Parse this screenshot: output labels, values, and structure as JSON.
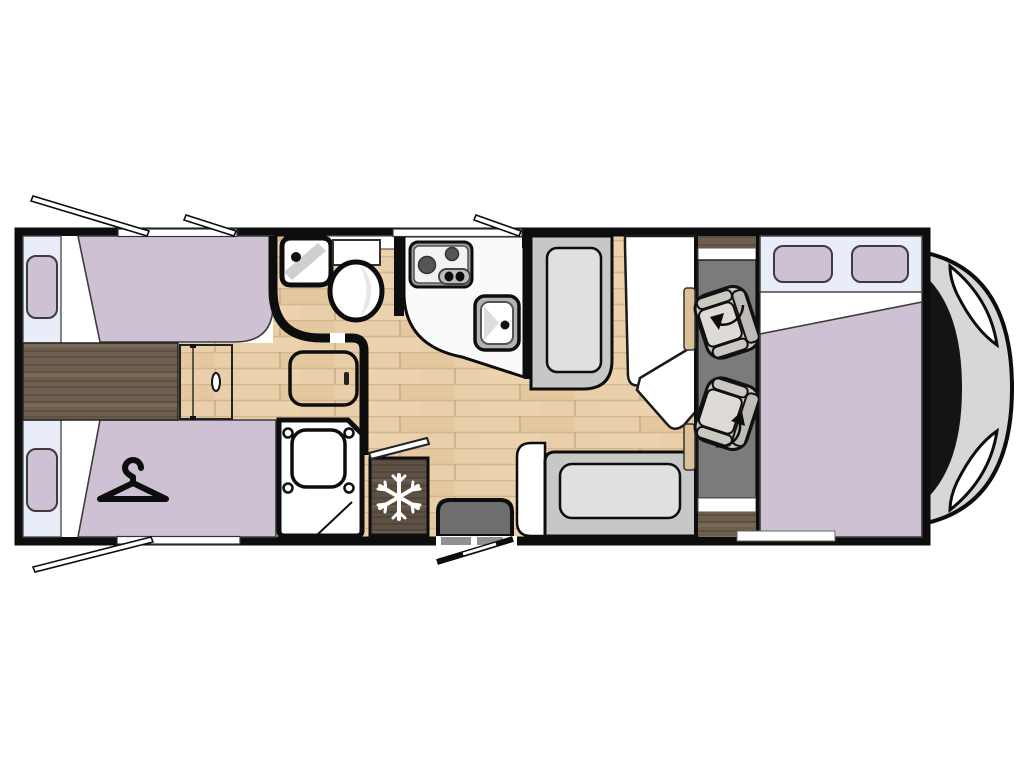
{
  "title": "Motorhome floor plan (top view)",
  "colors": {
    "wall": "#0d0d0d",
    "floor_base": "#e8cfa9",
    "floor_seam": "#d3b68b",
    "dark_wood": "#6d5f4f",
    "dark_wood_seam": "#5a4c3d",
    "fridge_wood": "#5d5144",
    "fridge_wood_seam": "#4d4336",
    "bed": "#cfc1d4",
    "window_band": "#e8edf9",
    "white": "#ffffff",
    "counter": "#fafafa",
    "bench": "#c7c7c7",
    "bench_cushion": "#e0e0e0",
    "cab_floor": "#7b7b7b",
    "seat_shell": "#cbc8c4",
    "seat_cushion": "#dedbd7",
    "step": "#6e6e6e",
    "stove_trim": "#9d9d9d",
    "sink_trim": "#b3b3b3",
    "nose_body": "#d7d7d7",
    "windshield": "#141414",
    "snowflake": "#ffffff",
    "side_cabinet": "#dcc098"
  },
  "icons": {
    "fridge": "snowflake-icon",
    "wardrobe": "clothes-hanger-icon",
    "cab_seats": "swivel-arrow-icon"
  },
  "areas": [
    "rear-twin-beds",
    "wardrobe",
    "bathroom",
    "shower",
    "kitchen",
    "fridge",
    "entry-door",
    "dinette",
    "swivel-cab-seats",
    "front-double-bed",
    "cab"
  ]
}
